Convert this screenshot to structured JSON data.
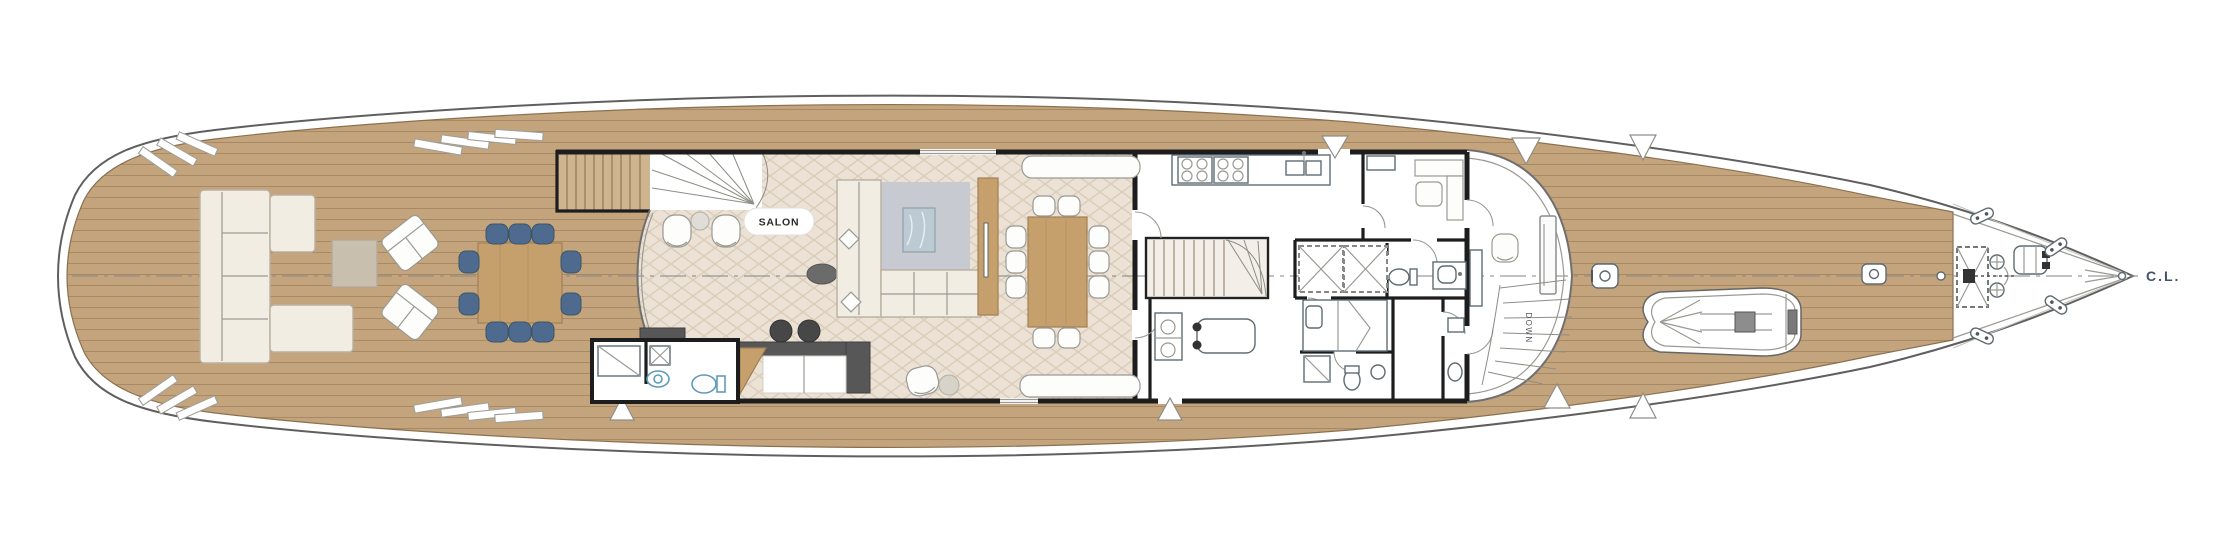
{
  "labels": {
    "salon": "SALON",
    "down": "DOWN",
    "centerline_marker": "C.L."
  },
  "palette": {
    "hullLine": "#5f5f5f",
    "teak": "#c4a47c",
    "teakPlank": "#8f7352",
    "teakEdge": "#8a7050",
    "wall": "#1d1d1d",
    "salonFloor": "#ebe1d4",
    "herringbone": "#d9cbb8",
    "wood": "#c6a06c",
    "woodEdge": "#a27e54",
    "blueChair": "#4e6a8e",
    "blueChairEdge": "#3a5568",
    "cream": "#f2ede2",
    "creamEdge": "#b9b0a0",
    "rug": "#c7cbd1",
    "marble": "#bccad3",
    "counterDark": "#575757",
    "stool": "#474747",
    "fixtureBlue": "#5f9cba",
    "stairTan": "#cfb58e",
    "labelInk": "#44536b",
    "textInk": "#2b2b2b"
  }
}
